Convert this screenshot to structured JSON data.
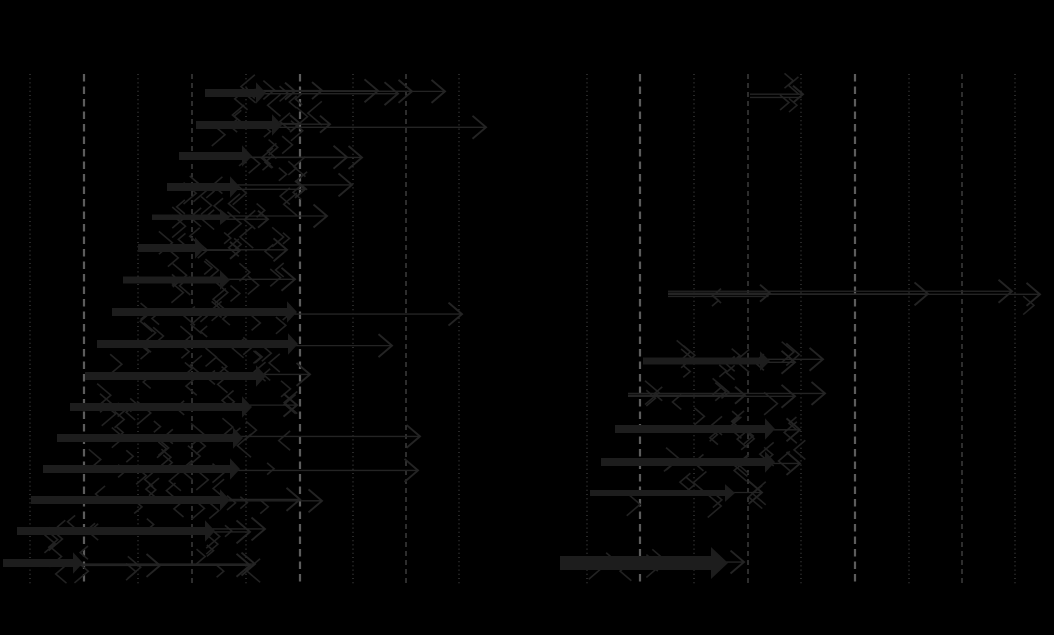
{
  "figure": {
    "width": 1054,
    "height": 635,
    "background": "#000000",
    "visible_text": []
  },
  "chart_data": {
    "type": "quiver",
    "description": "Two-panel horizontal arrow (shift) chart on black background; no legible text (labels rendered black on black). Each row shows a thick arrow bar plus thin overlapping arrows with chevron heads.",
    "grid": true,
    "plot_area": {
      "y_top": 74,
      "y_bottom": 584
    },
    "styles": {
      "bar_color": "#1d1d1d",
      "line_color": "#242424",
      "chevron_color": "#222222",
      "grid_dot_color": "#4f4f4f",
      "grid_dash_color": "#525252",
      "grid_heavy_color": "#5c5c5c"
    },
    "panels": [
      {
        "name": "left",
        "gridlines": [
          {
            "x": 30,
            "style": "dot"
          },
          {
            "x": 84,
            "style": "heavy"
          },
          {
            "x": 138,
            "style": "dot"
          },
          {
            "x": 192,
            "style": "dash"
          },
          {
            "x": 246,
            "style": "dot"
          },
          {
            "x": 300,
            "style": "heavy"
          },
          {
            "x": 353,
            "style": "dot"
          },
          {
            "x": 406,
            "style": "dash"
          },
          {
            "x": 459,
            "style": "dot"
          }
        ],
        "rows": [
          {
            "y": 93,
            "bar": [
              205,
              266,
              8
            ],
            "ends": [
              295,
              322,
              378,
              398,
              412,
              445
            ],
            "cluster": [
              225,
              300,
              8
            ]
          },
          {
            "y": 125,
            "bar": [
              196,
              282,
              8
            ],
            "ends": [
              300,
              330,
              486
            ],
            "cluster": [
              220,
              310,
              9
            ]
          },
          {
            "y": 156,
            "bar": [
              179,
              252,
              8
            ],
            "ends": [
              347,
              362
            ],
            "cluster": [
              205,
              300,
              10
            ]
          },
          {
            "y": 187,
            "bar": [
              167,
              240,
              8
            ],
            "ends": [
              305,
              352
            ],
            "cluster": [
              195,
              300,
              10
            ]
          },
          {
            "y": 217,
            "bar": [
              152,
              230,
              5
            ],
            "ends": [
              268,
              327
            ],
            "cluster": [
              175,
              290,
              12
            ]
          },
          {
            "y": 248,
            "bar": [
              138,
              205,
              8
            ],
            "ends": [
              240,
              287
            ],
            "cluster": [
              165,
              295,
              12
            ]
          },
          {
            "y": 280,
            "bar": [
              123,
              230,
              7
            ],
            "ends": [
              295
            ],
            "cluster": [
              150,
              290,
              12
            ]
          },
          {
            "y": 312,
            "bar": [
              112,
              297,
              8
            ],
            "ends": [
              462
            ],
            "cluster": [
              140,
              300,
              13
            ]
          },
          {
            "y": 344,
            "bar": [
              97,
              298,
              8
            ],
            "ends": [
              392
            ],
            "cluster": [
              130,
              300,
              13
            ]
          },
          {
            "y": 376,
            "bar": [
              85,
              266,
              8
            ],
            "ends": [
              310
            ],
            "cluster": [
              120,
              300,
              13
            ]
          },
          {
            "y": 407,
            "bar": [
              70,
              252,
              8
            ],
            "ends": [
              297
            ],
            "cluster": [
              110,
              295,
              13
            ]
          },
          {
            "y": 438,
            "bar": [
              57,
              243,
              8
            ],
            "ends": [
              420
            ],
            "cluster": [
              100,
              290,
              13
            ]
          },
          {
            "y": 469,
            "bar": [
              43,
              240,
              8
            ],
            "ends": [
              418
            ],
            "cluster": [
              90,
              285,
              13
            ]
          },
          {
            "y": 500,
            "bar": [
              31,
              230,
              8
            ],
            "ends": [
              300,
              322
            ],
            "cluster": [
              70,
              280,
              12
            ]
          },
          {
            "y": 531,
            "bar": [
              17,
              215,
              8
            ],
            "ends": [
              250,
              265
            ],
            "cluster": [
              55,
              265,
              11
            ]
          },
          {
            "y": 563,
            "bar": [
              3,
              83,
              8
            ],
            "ends": [
              160,
              250,
              255
            ],
            "cluster": [
              45,
              260,
              10
            ]
          }
        ]
      },
      {
        "name": "right",
        "gridlines": [
          {
            "x": 587,
            "style": "dot"
          },
          {
            "x": 640,
            "style": "heavy"
          },
          {
            "x": 694,
            "style": "dot"
          },
          {
            "x": 748,
            "style": "dash"
          },
          {
            "x": 801,
            "style": "dot"
          },
          {
            "x": 855,
            "style": "heavy"
          },
          {
            "x": 909,
            "style": "dot"
          },
          {
            "x": 962,
            "style": "dash"
          },
          {
            "x": 1015,
            "style": "dot"
          }
        ],
        "rows": [
          {
            "y": 93,
            "bar": null,
            "from": 750,
            "double": true,
            "ends": [
              803
            ],
            "cluster": [
              765,
              798,
              3
            ]
          },
          {
            "y": 293,
            "bar": null,
            "from": 668,
            "double": true,
            "ends": [
              770,
              928,
              1012,
              1040
            ],
            "cluster": [
              700,
              760,
              2
            ]
          },
          {
            "y": 361,
            "bar": [
              643,
              770,
              7
            ],
            "ends": [
              795,
              823
            ],
            "cluster": [
              690,
              800,
              12
            ]
          },
          {
            "y": 395,
            "bar": null,
            "from": 628,
            "ends": [
              745,
              795,
              825
            ],
            "cluster": [
              645,
              780,
              8
            ]
          },
          {
            "y": 429,
            "bar": [
              615,
              775,
              8
            ],
            "ends": [
              800
            ],
            "cluster": [
              700,
              805,
              12
            ]
          },
          {
            "y": 462,
            "bar": [
              601,
              775,
              8
            ],
            "ends": [
              800
            ],
            "cluster": [
              635,
              800,
              10
            ]
          },
          {
            "y": 493,
            "bar": [
              590,
              735,
              6
            ],
            "ends": [
              762
            ],
            "cluster": [
              640,
              765,
              8
            ]
          },
          {
            "y": 563,
            "bar": [
              560,
              728,
              14
            ],
            "big": true,
            "ends": [
              744
            ],
            "cluster": [
              595,
              700,
              6
            ]
          }
        ]
      }
    ]
  }
}
